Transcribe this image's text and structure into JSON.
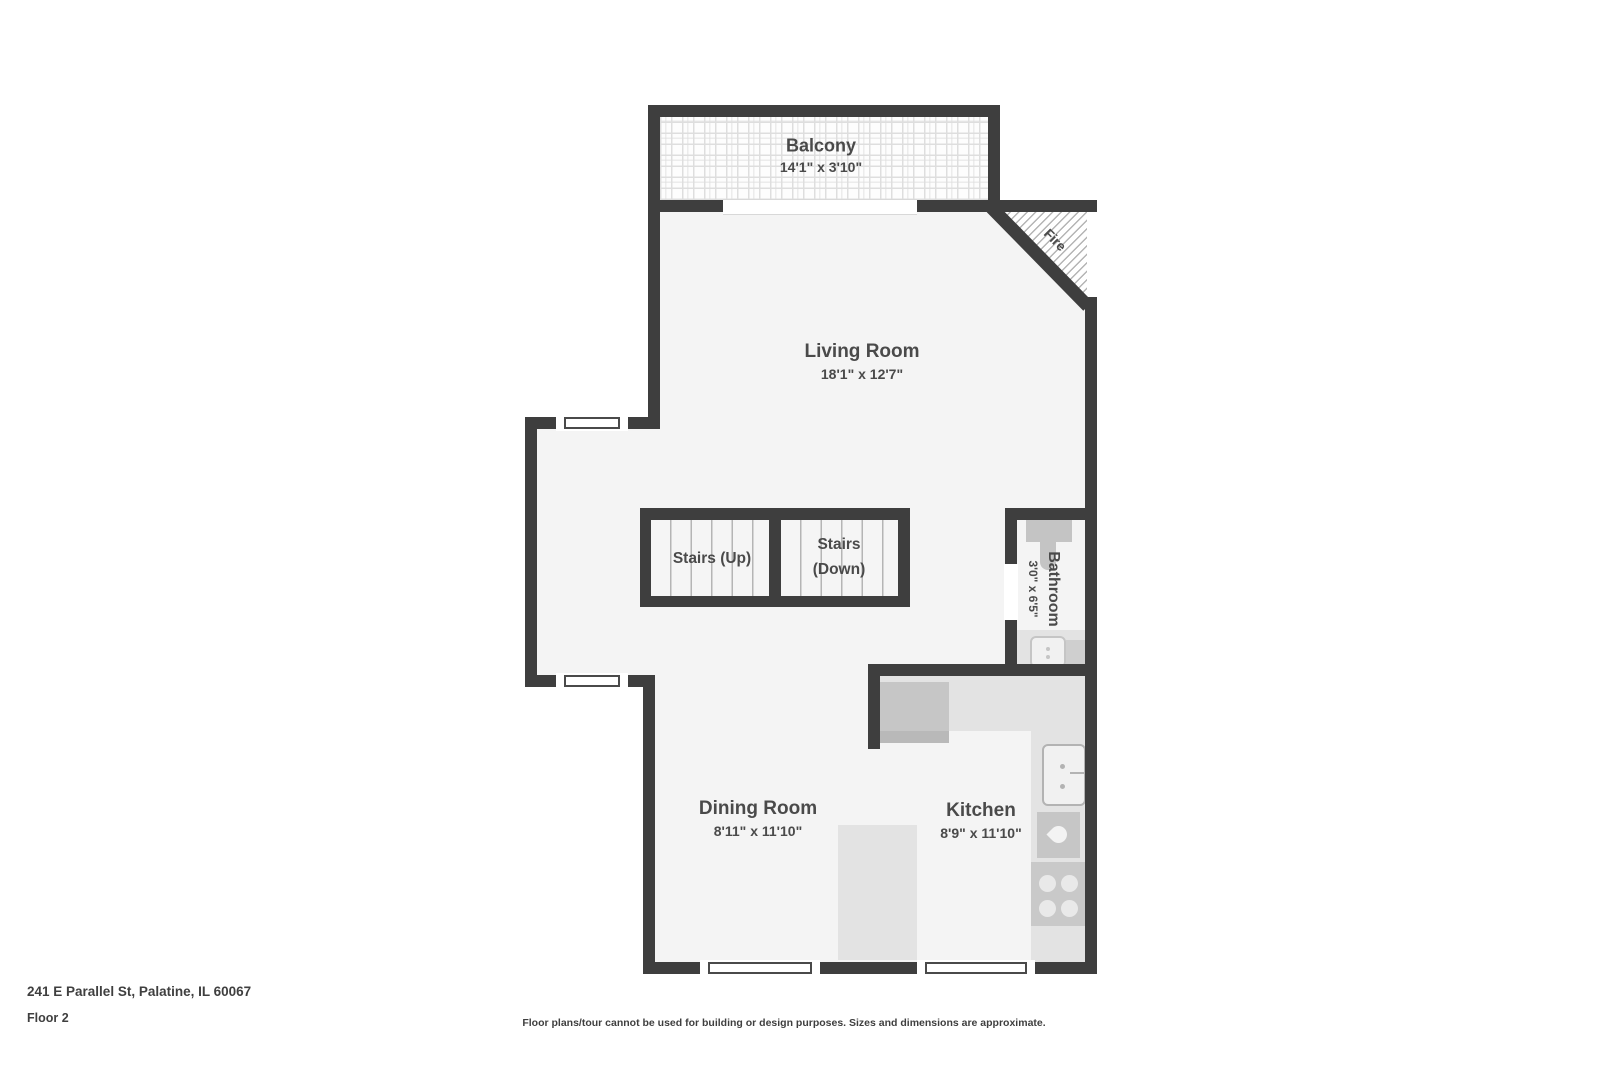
{
  "rooms": {
    "balcony": {
      "name": "Balcony",
      "dims": "14'1\" x 3'10\""
    },
    "living_room": {
      "name": "Living Room",
      "dims": "18'1\" x 12'7\""
    },
    "stairs_up": {
      "name": "Stairs (Up)"
    },
    "stairs_down": {
      "name": "Stairs (Down)"
    },
    "bathroom": {
      "name": "Bathroom",
      "dims": "3'0\" x 6'5\""
    },
    "dining_room": {
      "name": "Dining Room",
      "dims": "8'11\" x 11'10\""
    },
    "kitchen": {
      "name": "Kitchen",
      "dims": "8'9\" x 11'10\""
    },
    "fireplace": {
      "name": "Fire"
    }
  },
  "footer": {
    "address": "241 E Parallel St, Palatine, IL 60067",
    "floor": "Floor 2",
    "disclaimer": "Floor plans/tour cannot be used for building or design purposes. Sizes and dimensions are approximate."
  },
  "colors": {
    "wall": "#3e3e3e",
    "floor": "#f4f4f4",
    "counter": "#e3e3e3",
    "appliance": "#c6c6c6",
    "label_text": "#4a4a4a"
  }
}
